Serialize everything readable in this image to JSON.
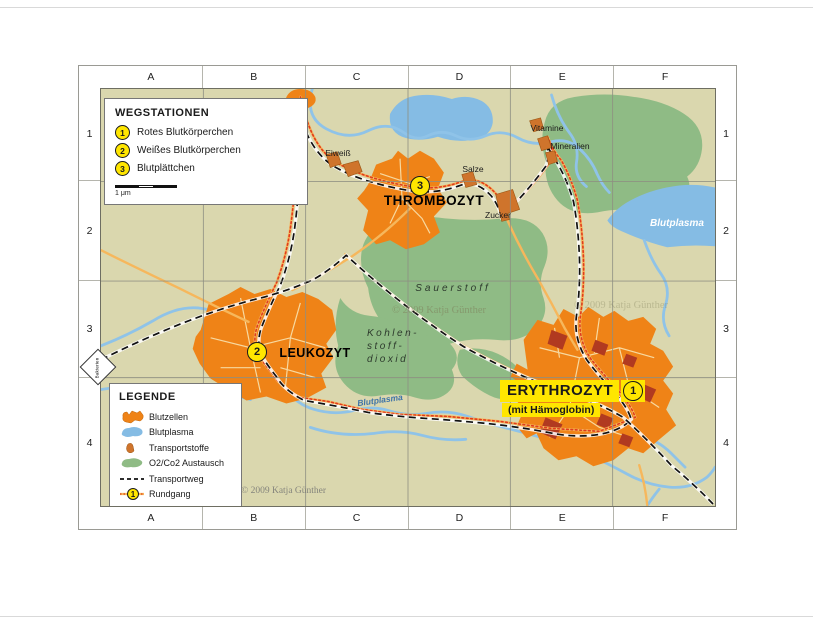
{
  "window": {
    "copyright": "© 2009 Katja Günther",
    "watermark": "© 2009 Katja Günther"
  },
  "grid": {
    "columns": [
      "A",
      "B",
      "C",
      "D",
      "E",
      "F"
    ],
    "rows": [
      "1",
      "2",
      "3",
      "4"
    ]
  },
  "wegstationen": {
    "title": "WEGSTATIONEN",
    "items": [
      {
        "num": "1",
        "label": "Rotes Blutkörperchen"
      },
      {
        "num": "2",
        "label": "Weißes Blutkörperchen"
      },
      {
        "num": "3",
        "label": "Blutplättchen"
      }
    ],
    "scale_label": "1 μm"
  },
  "legende": {
    "title": "LEGENDE",
    "items": [
      {
        "icon": "blutzellen-swatch",
        "label": "Blutzellen"
      },
      {
        "icon": "blutplasma-swatch",
        "label": "Blutplasma"
      },
      {
        "icon": "transportstoffe-swatch",
        "label": "Transportstoffe"
      },
      {
        "icon": "o2co2-swatch",
        "label": "O2/Co2 Austausch"
      },
      {
        "icon": "transportweg-line",
        "label": "Transportweg"
      },
      {
        "icon": "rundgang-line",
        "label": "Rundgang",
        "badge": "1"
      }
    ]
  },
  "stations": {
    "thrombozyt": {
      "num": "3",
      "name": "THROMBOZYT"
    },
    "leukozyt": {
      "num": "2",
      "name": "LEUKOZYT"
    },
    "erythrozyt": {
      "num": "1",
      "name": "ERYTHROZYT",
      "subtitle": "(mit Hämoglobin)"
    }
  },
  "map_labels": {
    "eiweiss": "Eiweiß",
    "salze": "Salze",
    "zucker": "Zucker",
    "vitamine": "Vitamine",
    "mineralien": "Mineralien",
    "blutplasma_lake": "Blutplasma",
    "blutplasma_river": "Blutplasma",
    "sauerstoff": "Sauerstoff",
    "kohlenstoffdioxid": "Kohlen-\nstoff-\ndioxid",
    "bakterien": "Bakterien"
  },
  "colors": {
    "map_bg": "#dad7ae",
    "green": "#8fbb85",
    "water": "#85bce4",
    "river": "#8fc3e8",
    "city": "#ef8317",
    "city_street": "#f7d9a0",
    "haemoglobin": "#b13a20",
    "building": "#cf742c",
    "road": "#f6b75c",
    "rundgang_red": "#e03c1e",
    "station_yellow": "#ffe600",
    "highlight_yellow": "#ffe600",
    "grid_line": "#8e8e82"
  }
}
